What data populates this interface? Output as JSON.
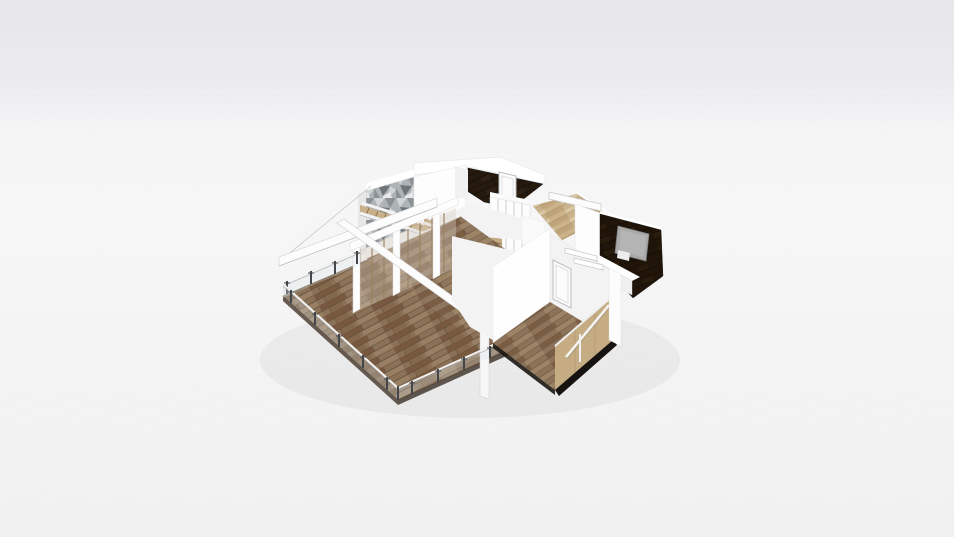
{
  "viewport": {
    "width": 954,
    "height": 537,
    "description": "3D perspective render of a single-storey house floor plan floating on an empty light-gray ground plane with a faint tile grid"
  },
  "scene": {
    "rooms": [
      {
        "id": "terrace",
        "label": "Terrace deck",
        "floor": "dark wood planks",
        "features": [
          "glass railing with dark posts",
          "white pergola beams",
          "pergola corner post"
        ]
      },
      {
        "id": "living-room",
        "label": "Living room",
        "floor": "wood planks",
        "features": [
          "glass sliding partition with wood mullions",
          "TV media wall",
          "staircase with tan treads",
          "gray stone accent wall"
        ]
      },
      {
        "id": "top-room",
        "label": "Room with dark tile floor",
        "features": [
          "white door",
          "sliding-door wardrobe with tan cubbies"
        ]
      },
      {
        "id": "hallway",
        "label": "Hallway",
        "floor": "light oak planks",
        "features": [
          "white floating shelf"
        ]
      },
      {
        "id": "right-room",
        "label": "Bedroom with dark tile floor",
        "features": [
          "gray bed",
          "low white parapet wall"
        ]
      },
      {
        "id": "stair-room",
        "label": "Staircase room",
        "floor": "wood planks",
        "features": [
          "white panel door",
          "tan stair wall with white handrail",
          "two white wall shelves"
        ]
      }
    ]
  },
  "colors": {
    "bg_top": "#e7e7ea",
    "bg_upper": "#ebebee",
    "bg_mid": "#f0f0f1",
    "bg_bottom": "#ebebeb",
    "grid_line": "#cdd0d6",
    "wall_lit": "#ffffff",
    "wall_bright": "#fdfdfd",
    "wall_soft": "#f3f3f3",
    "wall_shade": "#e8e8e8",
    "wall_edge": "#d6d6d6",
    "deck_base": "#8a7158",
    "deck_dark": "#78593f",
    "deck_light": "#997f63",
    "deck_line": "#5f4a35",
    "room_base": "#8f775f",
    "room_dark": "#7a5d43",
    "room_light": "#9d8466",
    "tan_base": "#cbb38c",
    "tan_dark": "#bfa47a",
    "tan_light": "#d9c7a4",
    "tan_line": "#a68e66",
    "darkfloor_base": "#261a0f",
    "darkfloor_line": "#120c06",
    "darkfloor2_base": "#211509",
    "stone_base": "#aeb3b6",
    "stone_light": "#d2d5d7",
    "stone_mid": "#8b9296",
    "stone_dark": "#6f767b",
    "stair_tread": "#c9b08a",
    "stair_rung": "#8d7456",
    "glass_fill": "#dce3e6",
    "glass_post": "#43474c",
    "tv_screen": "#141210",
    "cabinet_gray": "#b9bcbc",
    "cabinet_tan": "#c2aa83",
    "bed_gray": "#a9a9a9",
    "bed_edge": "#7f7f7f",
    "bed_light": "#b4b4b4",
    "bed_white": "#ececec",
    "door_face": "#fbfbfb",
    "door_frame": "#bdbdbd",
    "tan_wall": "#c6ac83",
    "tan_wall_line": "#b59b74",
    "void_dark": "#171310",
    "slab_dark": "#4e4034",
    "slab_dark2": "#443931",
    "rail_white": "#f2f2f2",
    "rail_shadow": "#b0b0b0"
  }
}
